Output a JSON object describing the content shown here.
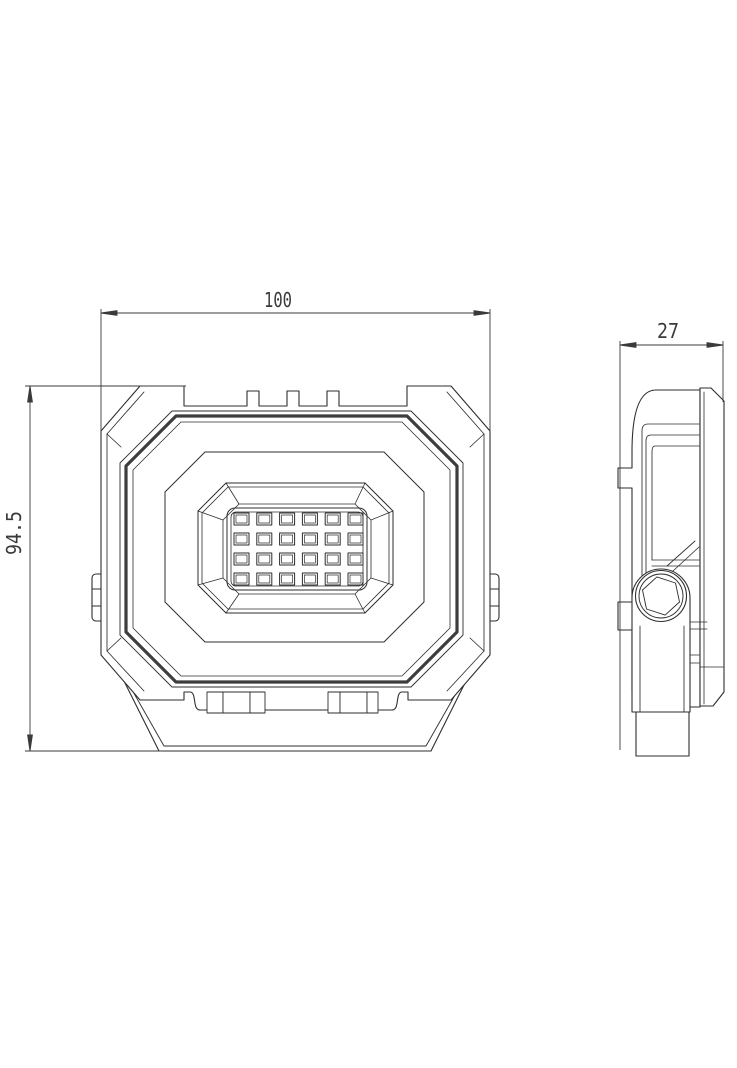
{
  "drawing": {
    "type": "technical-drawing",
    "subject": "LED floodlight orthographic projection, front view and side view",
    "background_color": "#ffffff",
    "line_color": "#2e2e2e",
    "thick_line_color": "#3d3d3d",
    "dim_color": "#3a3a3a",
    "views": [
      {
        "id": "front",
        "name": "front-view"
      },
      {
        "id": "side",
        "name": "side-view"
      }
    ],
    "dimensions": [
      {
        "id": "width",
        "label": "100",
        "view": "front",
        "orientation": "horizontal"
      },
      {
        "id": "height",
        "label": "94.5",
        "view": "front",
        "orientation": "vertical"
      },
      {
        "id": "depth",
        "label": "27",
        "view": "side",
        "orientation": "horizontal"
      }
    ],
    "front_view": {
      "led_grid": {
        "rows": 4,
        "cols": 6,
        "count": 24
      }
    }
  }
}
